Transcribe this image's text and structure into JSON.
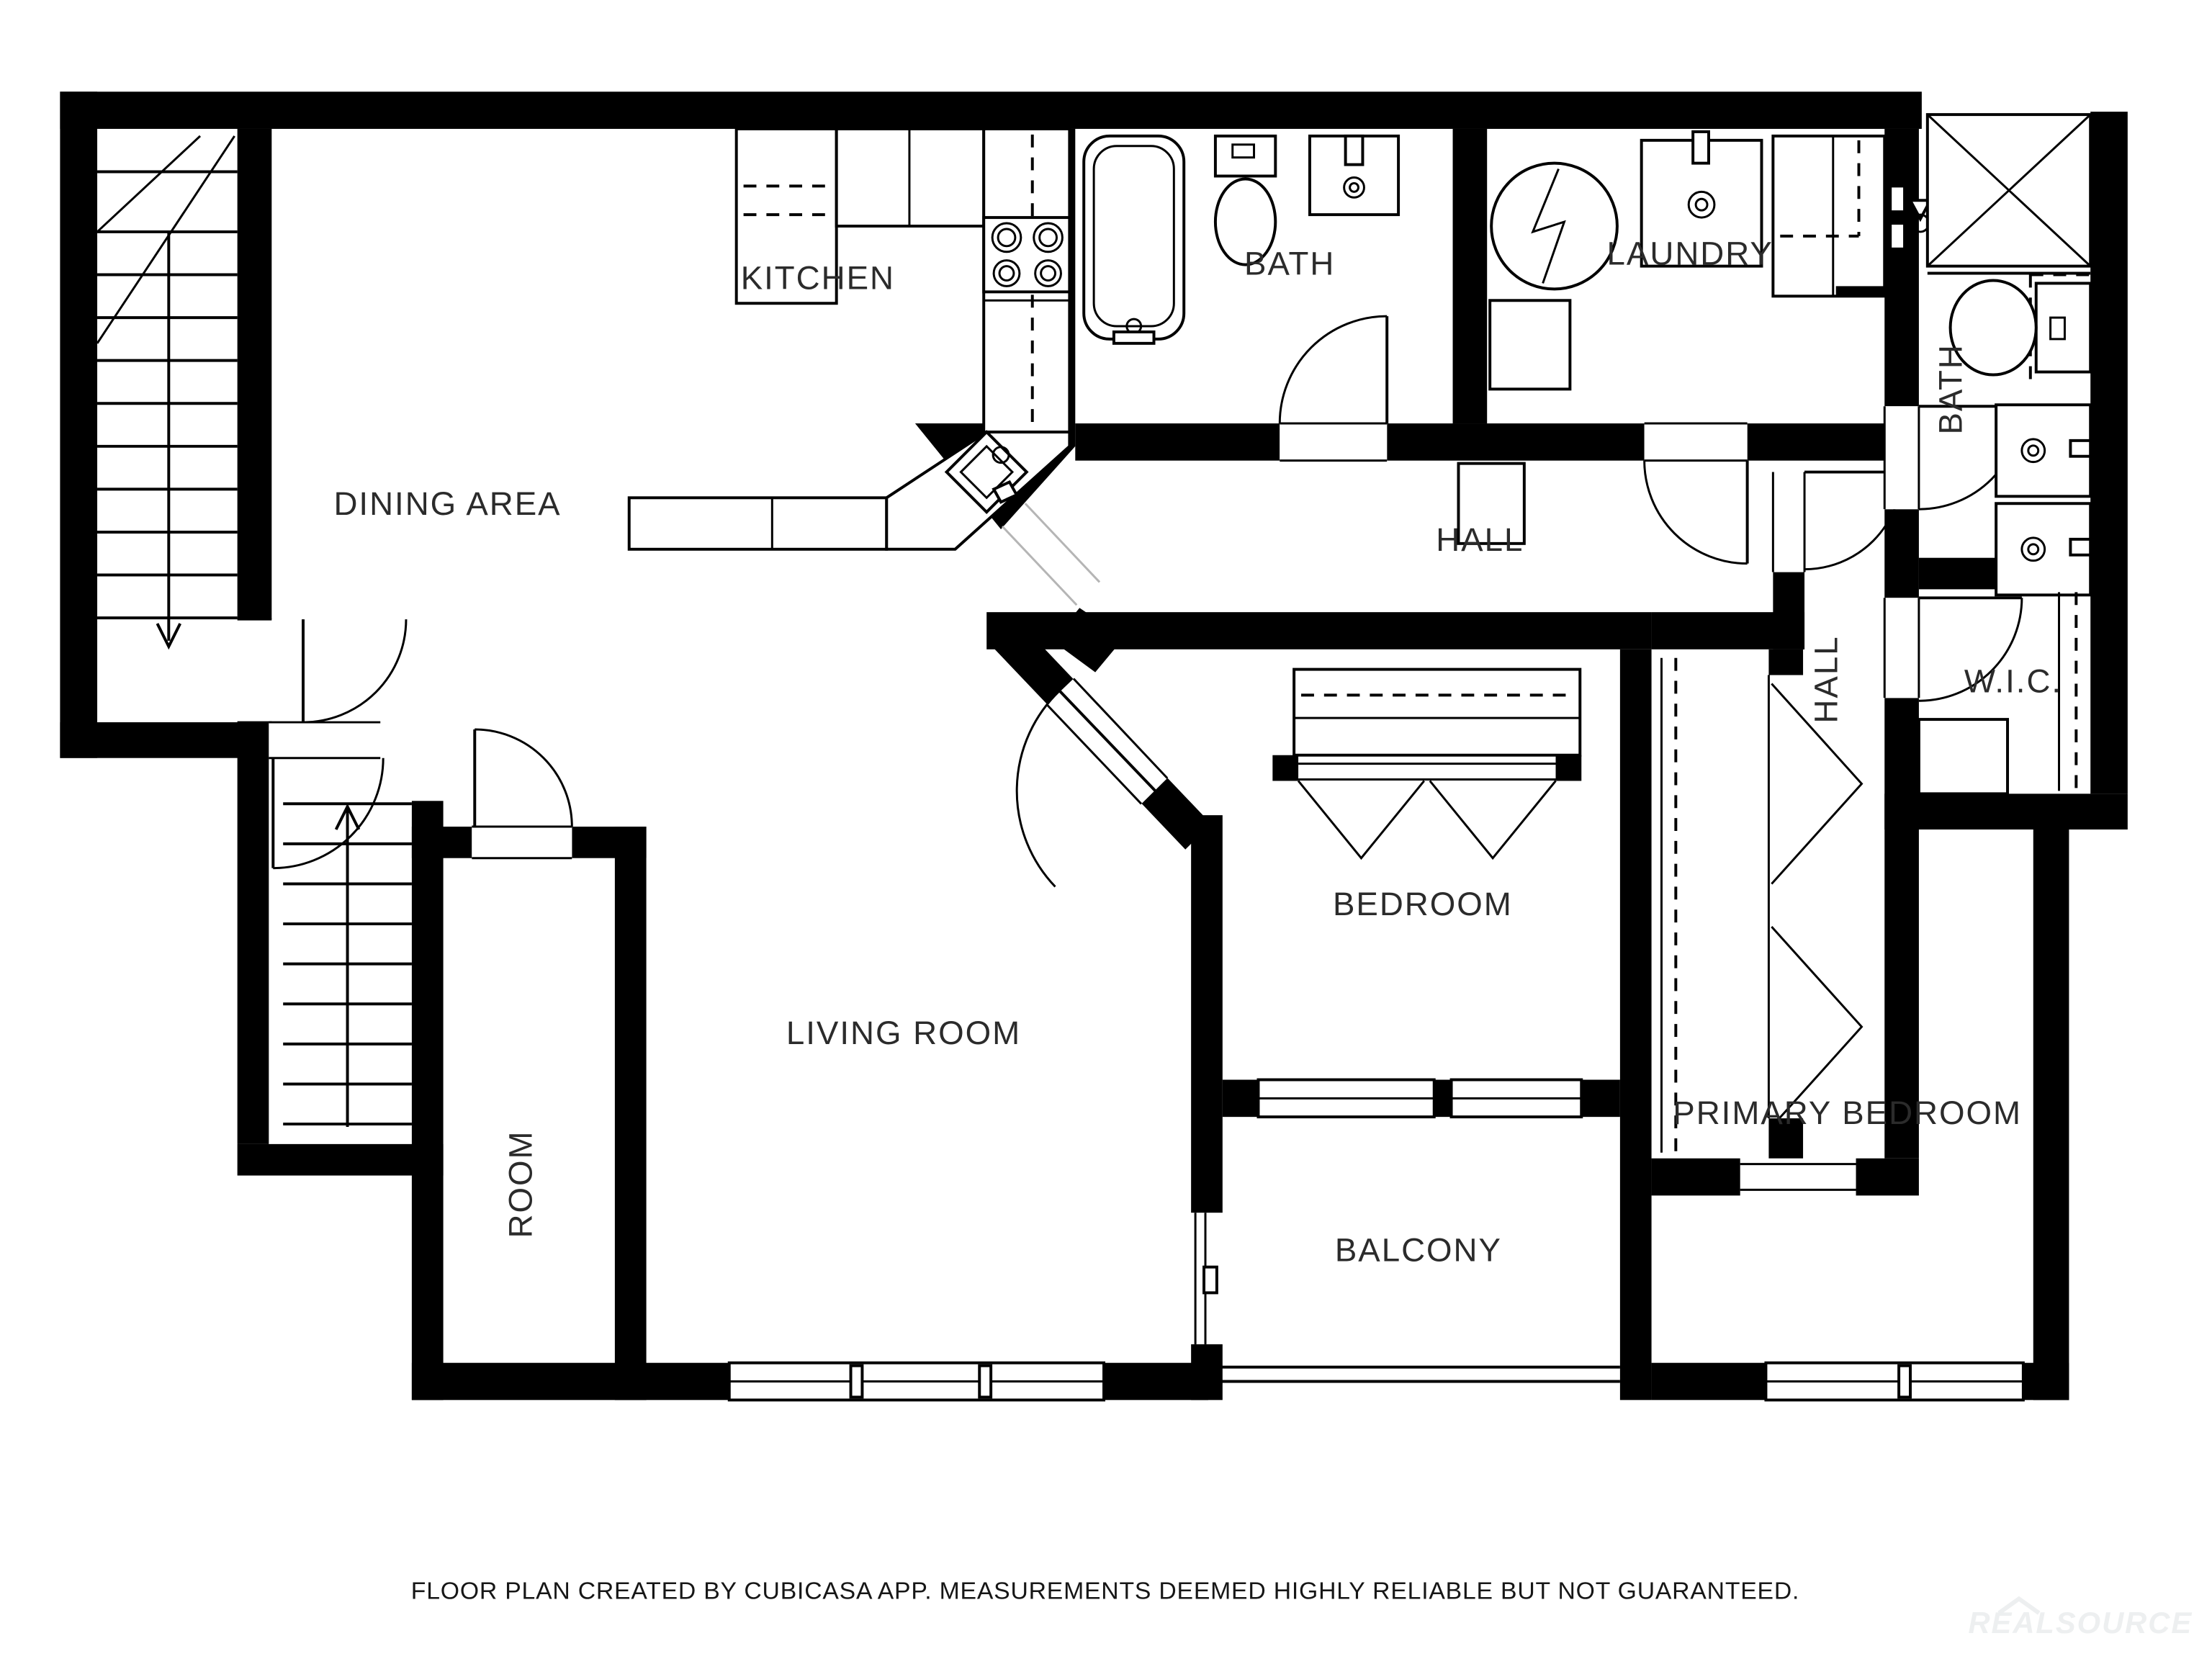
{
  "page": {
    "background": "#ffffff",
    "type": "floor-plan"
  },
  "rooms": {
    "dining_area": "DINING AREA",
    "kitchen": "KITCHEN",
    "bath_top": "BATH",
    "laundry": "LAUNDRY",
    "hall_upper": "HALL",
    "bath_right": "BATH",
    "hall_right": "HALL",
    "wic": "W.I.C.",
    "bedroom": "BEDROOM",
    "living_room": "LIVING ROOM",
    "room": "ROOM",
    "balcony": "BALCONY",
    "primary_bedroom": "PRIMARY BEDROOM"
  },
  "footer": {
    "disclaimer": "FLOOR PLAN CREATED BY CUBICASA APP. MEASUREMENTS DEEMED HIGHLY RELIABLE BUT NOT GUARANTEED."
  },
  "watermark": {
    "text": "REALSOURCE"
  },
  "colors": {
    "wall": "#000000",
    "background": "#ffffff",
    "label": "#2b2b2b",
    "watermark": "#edeff0"
  },
  "fixtures": [
    "staircase-down",
    "staircase-up",
    "bathtub",
    "toilet",
    "sink",
    "washing-machine",
    "stove",
    "kitchen-sink",
    "shower-box",
    "double-vanity",
    "closet-rod",
    "bifold-doors",
    "balcony-railing",
    "windows",
    "door-swings",
    "shower-head",
    "counter",
    "refrigerator"
  ]
}
